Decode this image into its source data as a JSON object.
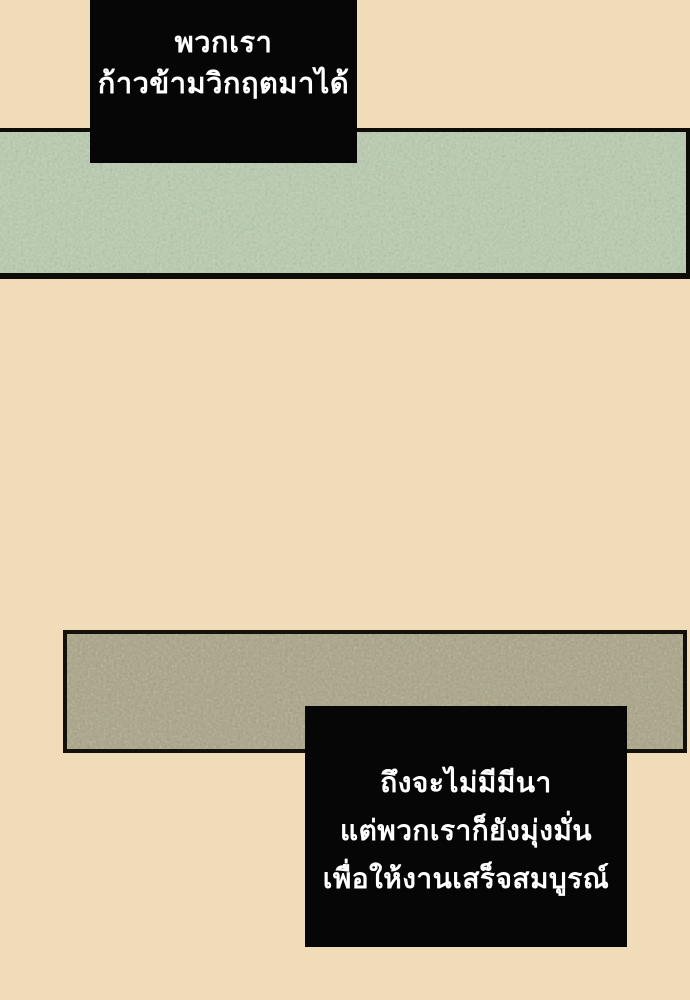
{
  "page": {
    "background_color": "#f1dcba",
    "outline_color": "#0e0c07"
  },
  "panels": {
    "green_strip": {
      "description": "textured sage-green horizontal panel",
      "fill": "#b9cdae"
    },
    "olive_strip": {
      "description": "textured olive-khaki horizontal panel",
      "fill": "#a9a483"
    }
  },
  "speech": {
    "top": {
      "bg": "#060606",
      "text_color": "#ffffff",
      "lines": {
        "0": "พวกเรา",
        "1": "ก้าวข้ามวิกฤตมาได้"
      }
    },
    "bottom": {
      "bg": "#060606",
      "text_color": "#ffffff",
      "lines": {
        "0": "ถึงจะไม่มีมีนา",
        "1": "แต่พวกเราก็ยังมุ่งมั่น",
        "2": "เพื่อให้งานเสร็จสมบูรณ์"
      }
    }
  }
}
